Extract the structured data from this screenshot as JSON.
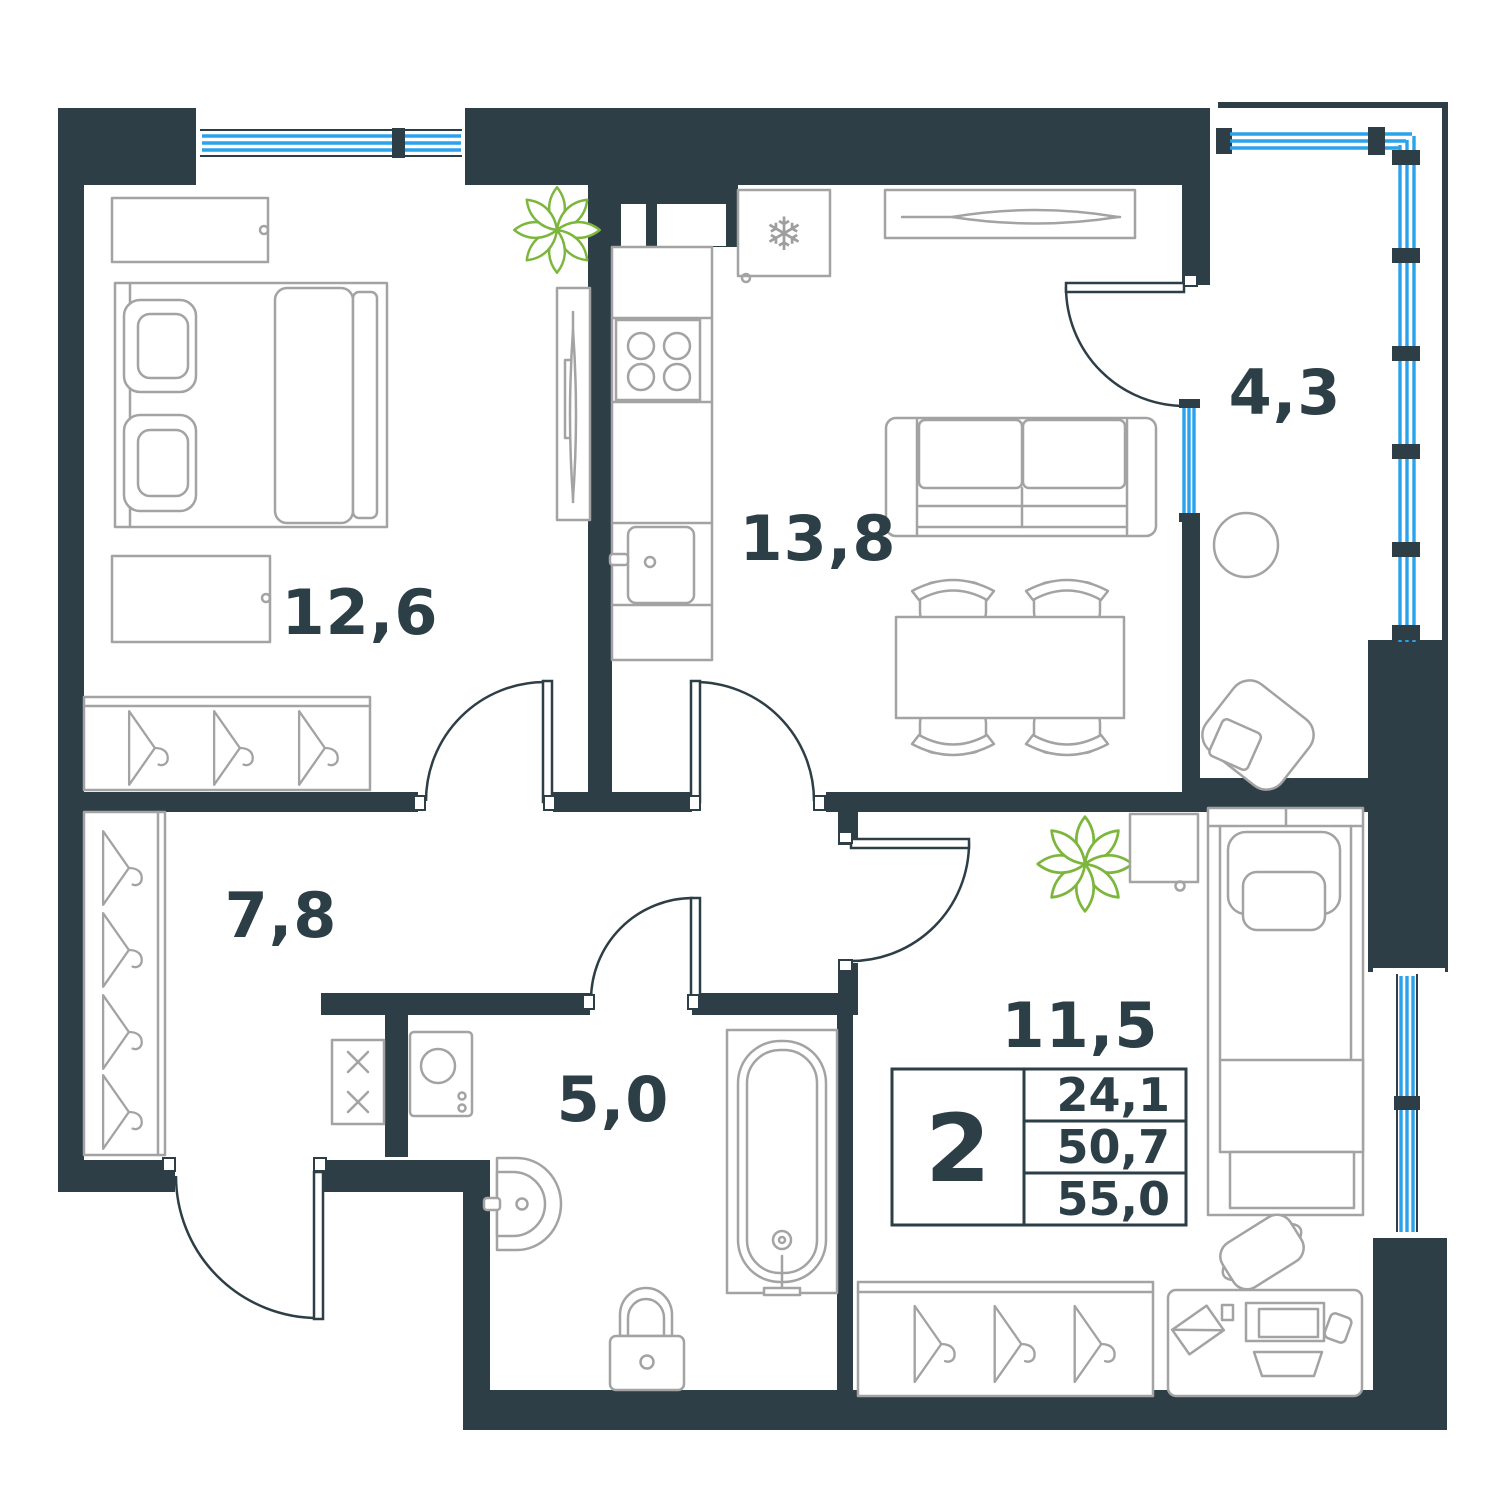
{
  "plan_type": "apartment-floor-plan",
  "rooms": [
    {
      "id": "bedroom-1",
      "area": "12,6"
    },
    {
      "id": "kitchen-living-room",
      "area": "13,8"
    },
    {
      "id": "balcony",
      "area": "4,3"
    },
    {
      "id": "hallway",
      "area": "7,8"
    },
    {
      "id": "bathroom",
      "area": "5,0"
    },
    {
      "id": "bedroom-2",
      "area": "11,5"
    }
  ],
  "info_table": {
    "rooms_count": "2",
    "rows": [
      "24,1",
      "50,7",
      "55,0"
    ]
  },
  "icons": {
    "fridge_snowflake": "❄"
  },
  "colors": {
    "wall": "#2d3e46",
    "window_glazing": "#2aa2ec",
    "furniture_outline": "#a3a3a3",
    "plant_green": "#7db63c",
    "label_text": "#2c3e46",
    "background": "#ffffff"
  }
}
